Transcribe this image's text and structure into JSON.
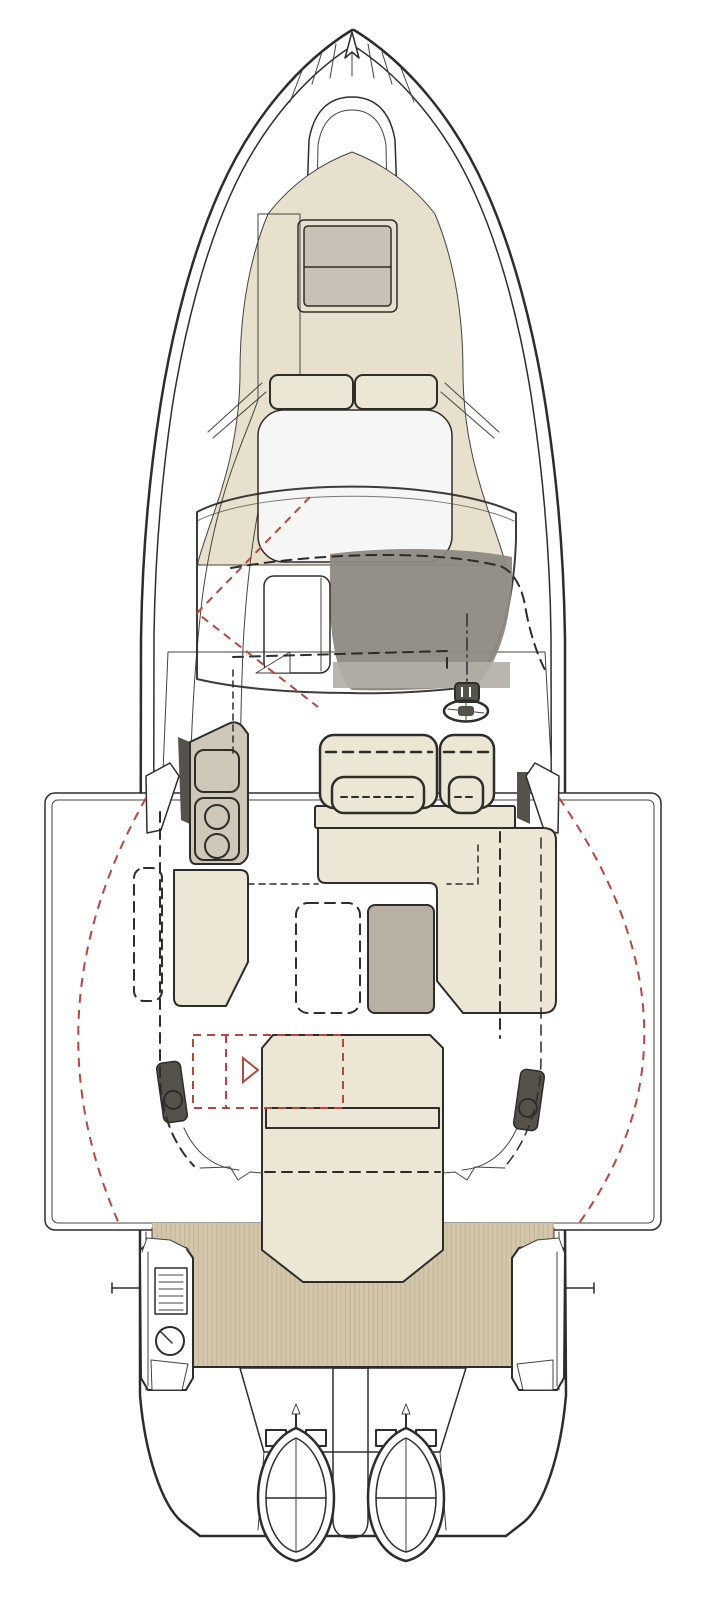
{
  "diagram_type": "boat-deck-plan-top-view",
  "colors": {
    "background": "#ffffff",
    "outline": "#2e2d2a",
    "line_soft": "#44433e",
    "deck_teak": "#d3c6ab",
    "teak_stripe": "#b3a689",
    "bow_pad": "#e7e0cd",
    "upholstery": "#ece6d5",
    "hatch_gray": "#c8c1b5",
    "table_gray": "#b7b0a3",
    "galley_gray": "#cfc7b8",
    "windshield_top": "#d9d8d5",
    "windshield_mid": "#bcbab4",
    "windshield_bottom": "#928e86",
    "dashboard": "#8e8a83",
    "step_gray": "#b2aea6",
    "roof_white": "#f6f6f4",
    "hatch_panel": "#e8e7e3",
    "fixture_dark": "#55524c",
    "accent_red": "#b5483f"
  }
}
